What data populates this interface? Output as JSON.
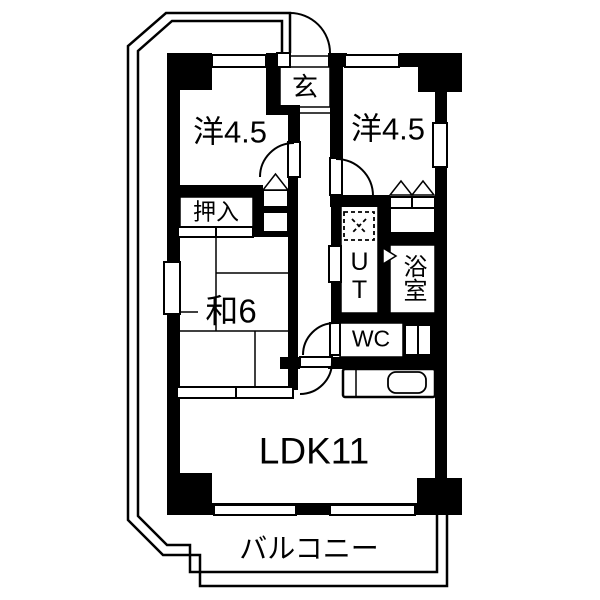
{
  "plan": {
    "type": "apartment-floorplan",
    "rooms": {
      "genkan": {
        "label": "玄"
      },
      "western_left": {
        "label": "洋4.5"
      },
      "western_right": {
        "label": "洋4.5"
      },
      "oshiire": {
        "label": "押入"
      },
      "washitsu": {
        "label": "和6"
      },
      "utility": {
        "label": "UT"
      },
      "bath": {
        "label": "浴室"
      },
      "wc": {
        "label": "WC"
      },
      "ldk": {
        "label": "LDK11"
      },
      "balcony": {
        "label": "バルコニー"
      }
    },
    "colors": {
      "wall": "#000000",
      "background": "#ffffff",
      "line": "#000000"
    }
  }
}
